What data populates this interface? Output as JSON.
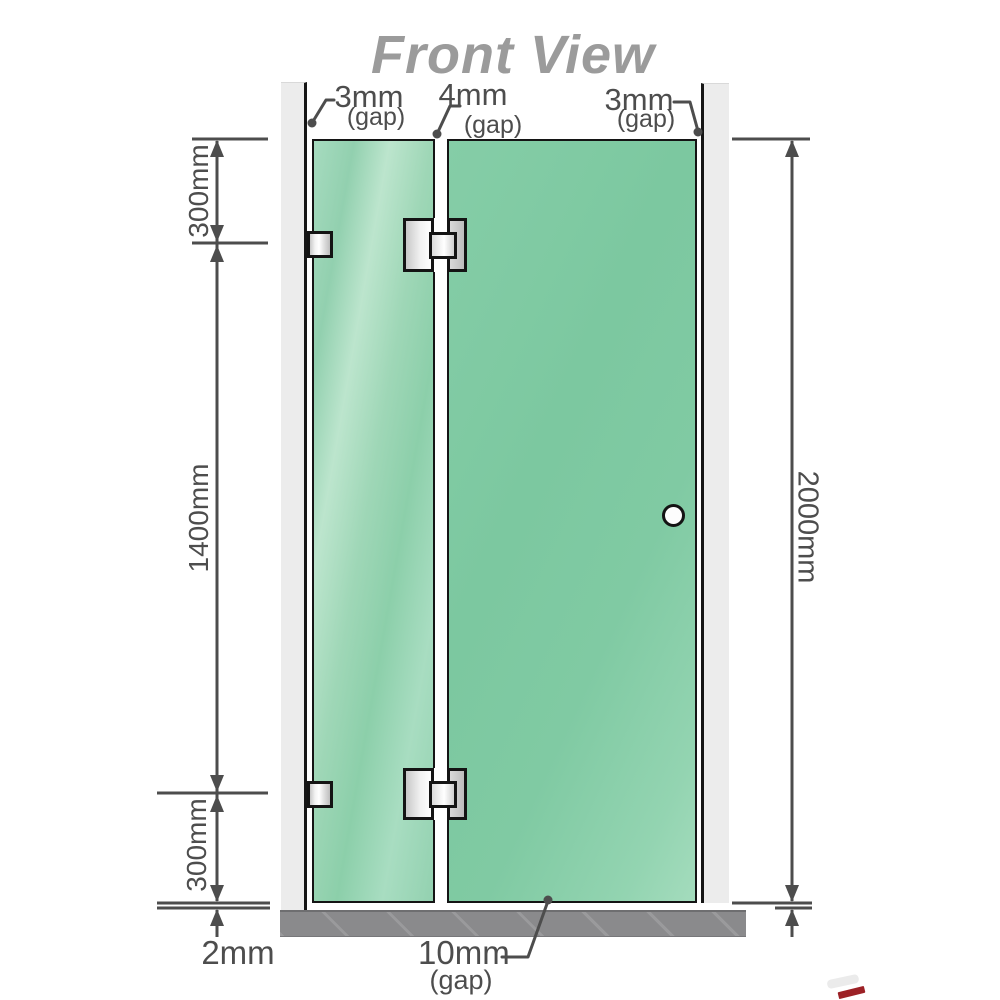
{
  "title": "Front View",
  "labels": {
    "top_gaps": [
      {
        "value": "3mm",
        "note": "(gap)"
      },
      {
        "value": "4mm",
        "note": "(gap)"
      },
      {
        "value": "3mm",
        "note": "(gap)"
      }
    ],
    "left_dims": [
      "300mm",
      "1400mm",
      "300mm"
    ],
    "right_dim": "2000mm",
    "bottom_left_dim": "2mm",
    "bottom_gap": {
      "value": "10mm",
      "note": "(gap)"
    }
  },
  "components": {
    "left_panel": "fixed-glass-panel",
    "right_panel": "glass-door-panel",
    "hinges": 2,
    "wall_brackets": 2,
    "door_knob": 1
  },
  "colors": {
    "glass_left": "#9dd5b6",
    "glass_right": "#7ec9a2",
    "wall": "#ececec",
    "floor": "#8a8a8c",
    "dimension": "#4d4d4d",
    "title": "#9b9b9b",
    "outline": "#141414",
    "hardware_silver": "#e0e0e0",
    "artifact_red": "#9c2126"
  }
}
